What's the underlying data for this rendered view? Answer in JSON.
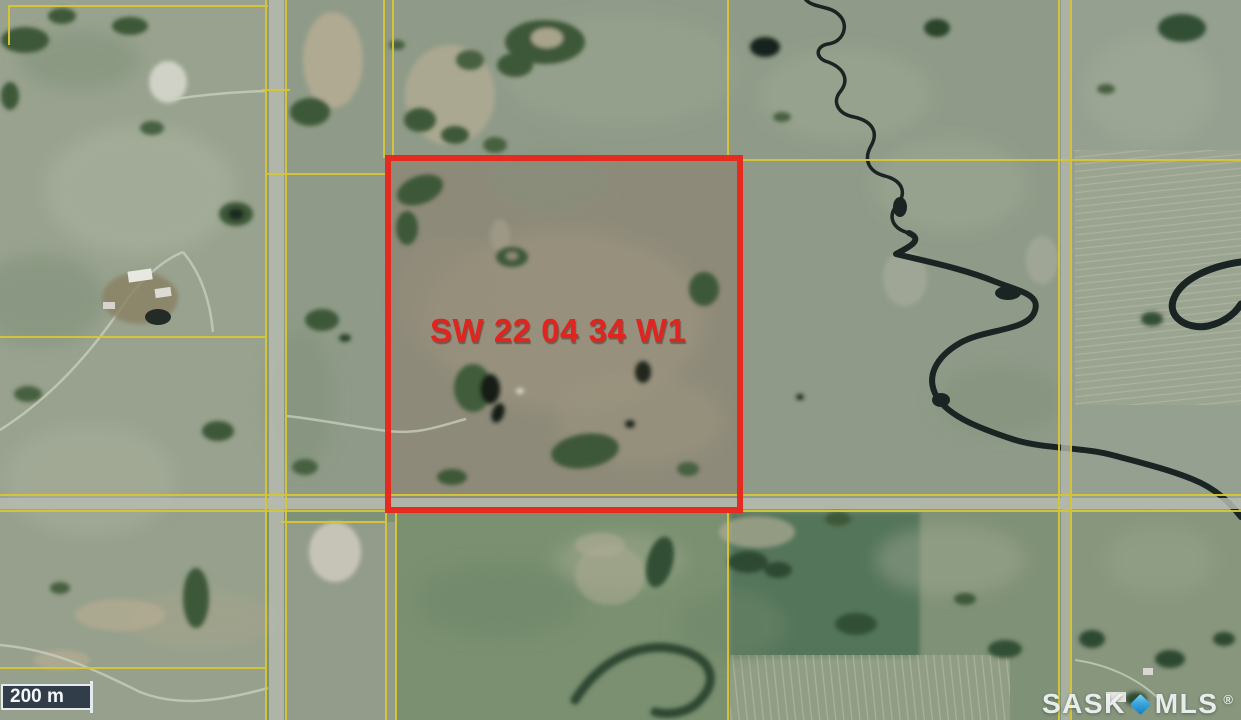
{
  "map": {
    "description": "Aerial satellite imagery of rural land with township grid lines",
    "parcel": {
      "label": "SW 22 04 34 W1",
      "quarter": "SW",
      "section": "22",
      "township": "04",
      "range": "34",
      "meridian": "W1",
      "outline_color": "#e8251c"
    },
    "scale_bar": {
      "label": "200 m"
    },
    "watermark": {
      "sask": "SASK",
      "mls": "MLS",
      "registered": "®",
      "diamond_color": "#2e95d2"
    },
    "colors": {
      "section_line_yellow": "#d8c636",
      "road_gray": "#b6bbb0",
      "creek_dark": "#1a2422",
      "terrain_base": "#8f9b88",
      "parcel_interior": "#8e8a79"
    }
  }
}
